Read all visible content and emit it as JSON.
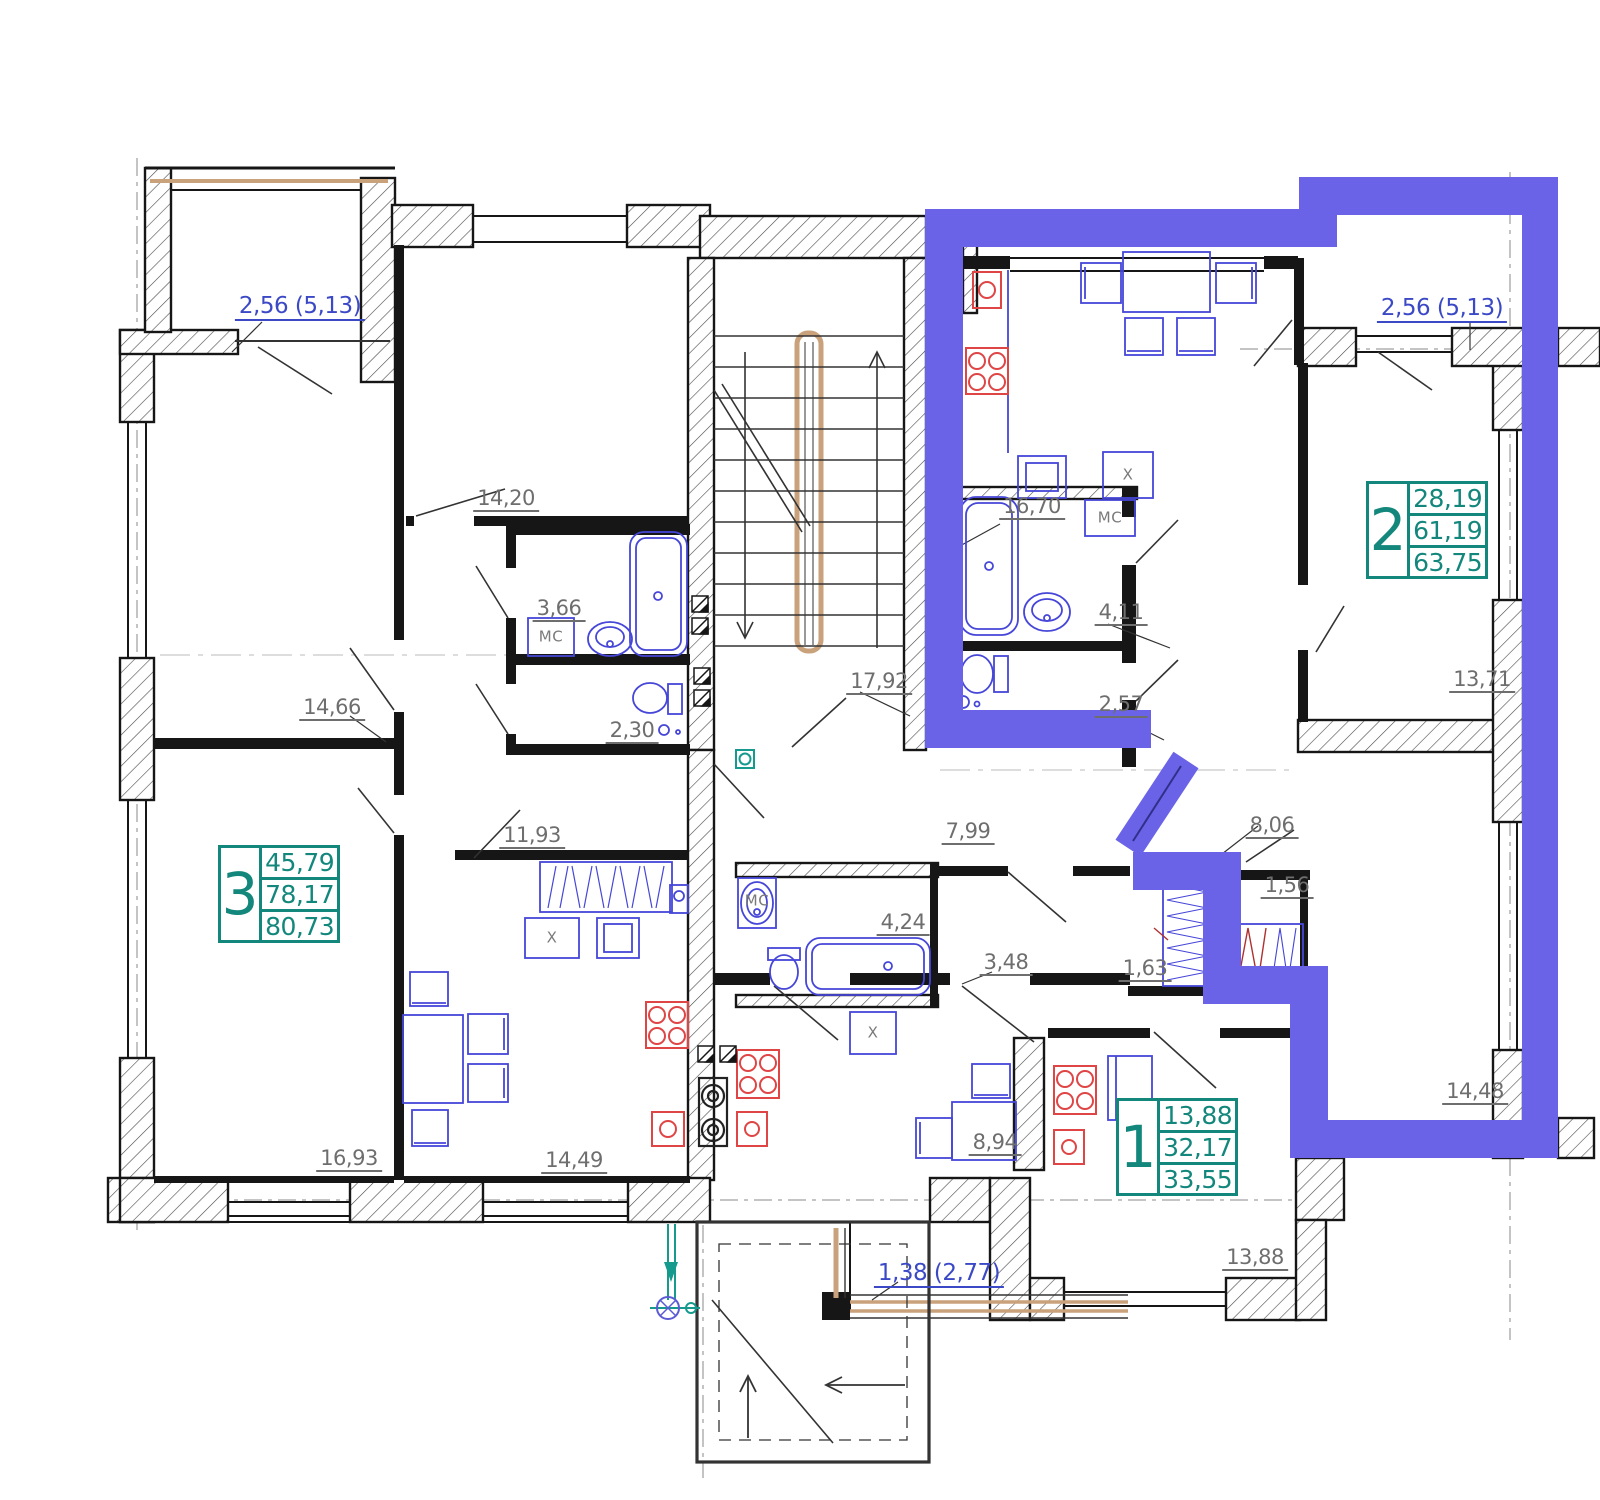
{
  "colors": {
    "highlight_purple": "#6a63e8",
    "teal_accent": "#13877c",
    "label_blue": "#3b49c6",
    "label_gray": "#6e6e6e",
    "furniture_blue": "#4646d8",
    "fixture_red": "#e04545",
    "wood_tan": "#c9a27c",
    "wall_black": "#161616",
    "utility_teal": "#169a8d"
  },
  "apartments": [
    {
      "id": "apt-2",
      "number": "2",
      "line1": "28,19",
      "line2": "61,19",
      "line3": "63,75"
    },
    {
      "id": "apt-3",
      "number": "3",
      "line1": "45,79",
      "line2": "78,17",
      "line3": "80,73"
    },
    {
      "id": "apt-1",
      "number": "1",
      "line1": "13,88",
      "line2": "32,17",
      "line3": "33,55"
    }
  ],
  "room_labels": [
    {
      "text": "14,20"
    },
    {
      "text": "3,66"
    },
    {
      "text": "2,30"
    },
    {
      "text": "14,66"
    },
    {
      "text": "16,93"
    },
    {
      "text": "11,93"
    },
    {
      "text": "14,49"
    },
    {
      "text": "17,92"
    },
    {
      "text": "7,99"
    },
    {
      "text": "4,24"
    },
    {
      "text": "3,48"
    },
    {
      "text": "8,94"
    },
    {
      "text": "16,70"
    },
    {
      "text": "4,11"
    },
    {
      "text": "2,57"
    },
    {
      "text": "8,06"
    },
    {
      "text": "1,56"
    },
    {
      "text": "1,63"
    },
    {
      "text": "13,71"
    },
    {
      "text": "14,48"
    },
    {
      "text": "13,88"
    }
  ],
  "balcony_labels": [
    {
      "text": "2,56 (5,13)"
    },
    {
      "text": "2,56 (5,13)"
    },
    {
      "text": "1,38 (2,77)"
    }
  ],
  "mc_labels": [
    {
      "text": "МС"
    },
    {
      "text": "МС"
    },
    {
      "text": "МС"
    }
  ],
  "x_labels": [
    {
      "text": "X"
    },
    {
      "text": "X"
    },
    {
      "text": "X"
    }
  ]
}
